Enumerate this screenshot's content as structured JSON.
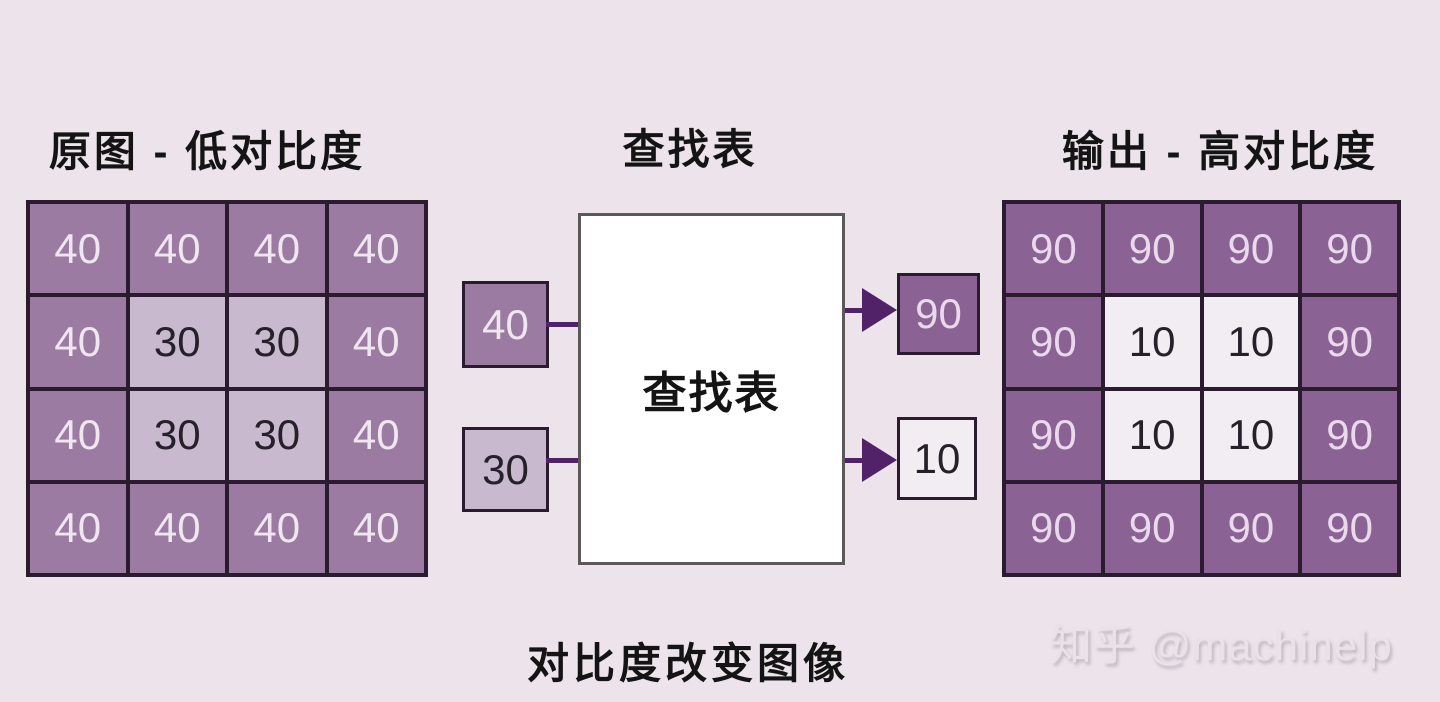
{
  "left_panel": {
    "title": "原图 - 低对比度",
    "grid": [
      [
        "40",
        "40",
        "40",
        "40"
      ],
      [
        "40",
        "30",
        "30",
        "40"
      ],
      [
        "40",
        "30",
        "30",
        "40"
      ],
      [
        "40",
        "40",
        "40",
        "40"
      ]
    ]
  },
  "lut": {
    "title": "查找表",
    "box_label": "查找表",
    "mappings": [
      {
        "input": "40",
        "output": "90"
      },
      {
        "input": "30",
        "output": "10"
      }
    ]
  },
  "right_panel": {
    "title": "输出 - 高对比度",
    "grid": [
      [
        "90",
        "90",
        "90",
        "90"
      ],
      [
        "90",
        "10",
        "10",
        "90"
      ],
      [
        "90",
        "10",
        "10",
        "90"
      ],
      [
        "90",
        "90",
        "90",
        "90"
      ]
    ]
  },
  "caption": "对比度改变图像",
  "watermark": "知乎 @machinelp",
  "colors": {
    "background": "#ece3eb",
    "grid_line": "#2a1c2e",
    "lut_box_border": "#5a5a5a",
    "connector_purple": "#512268",
    "title_text": "#141414",
    "watermark_text": "#e9e2e9",
    "cells": {
      "40": {
        "bg": "#9c7ba2",
        "fg": "#efe6f0"
      },
      "30": {
        "bg": "#c9b9cf",
        "fg": "#26202a"
      },
      "90": {
        "bg": "#8a6394",
        "fg": "#ead9ec"
      },
      "10": {
        "bg": "#f2edf3",
        "fg": "#26202a"
      }
    }
  }
}
